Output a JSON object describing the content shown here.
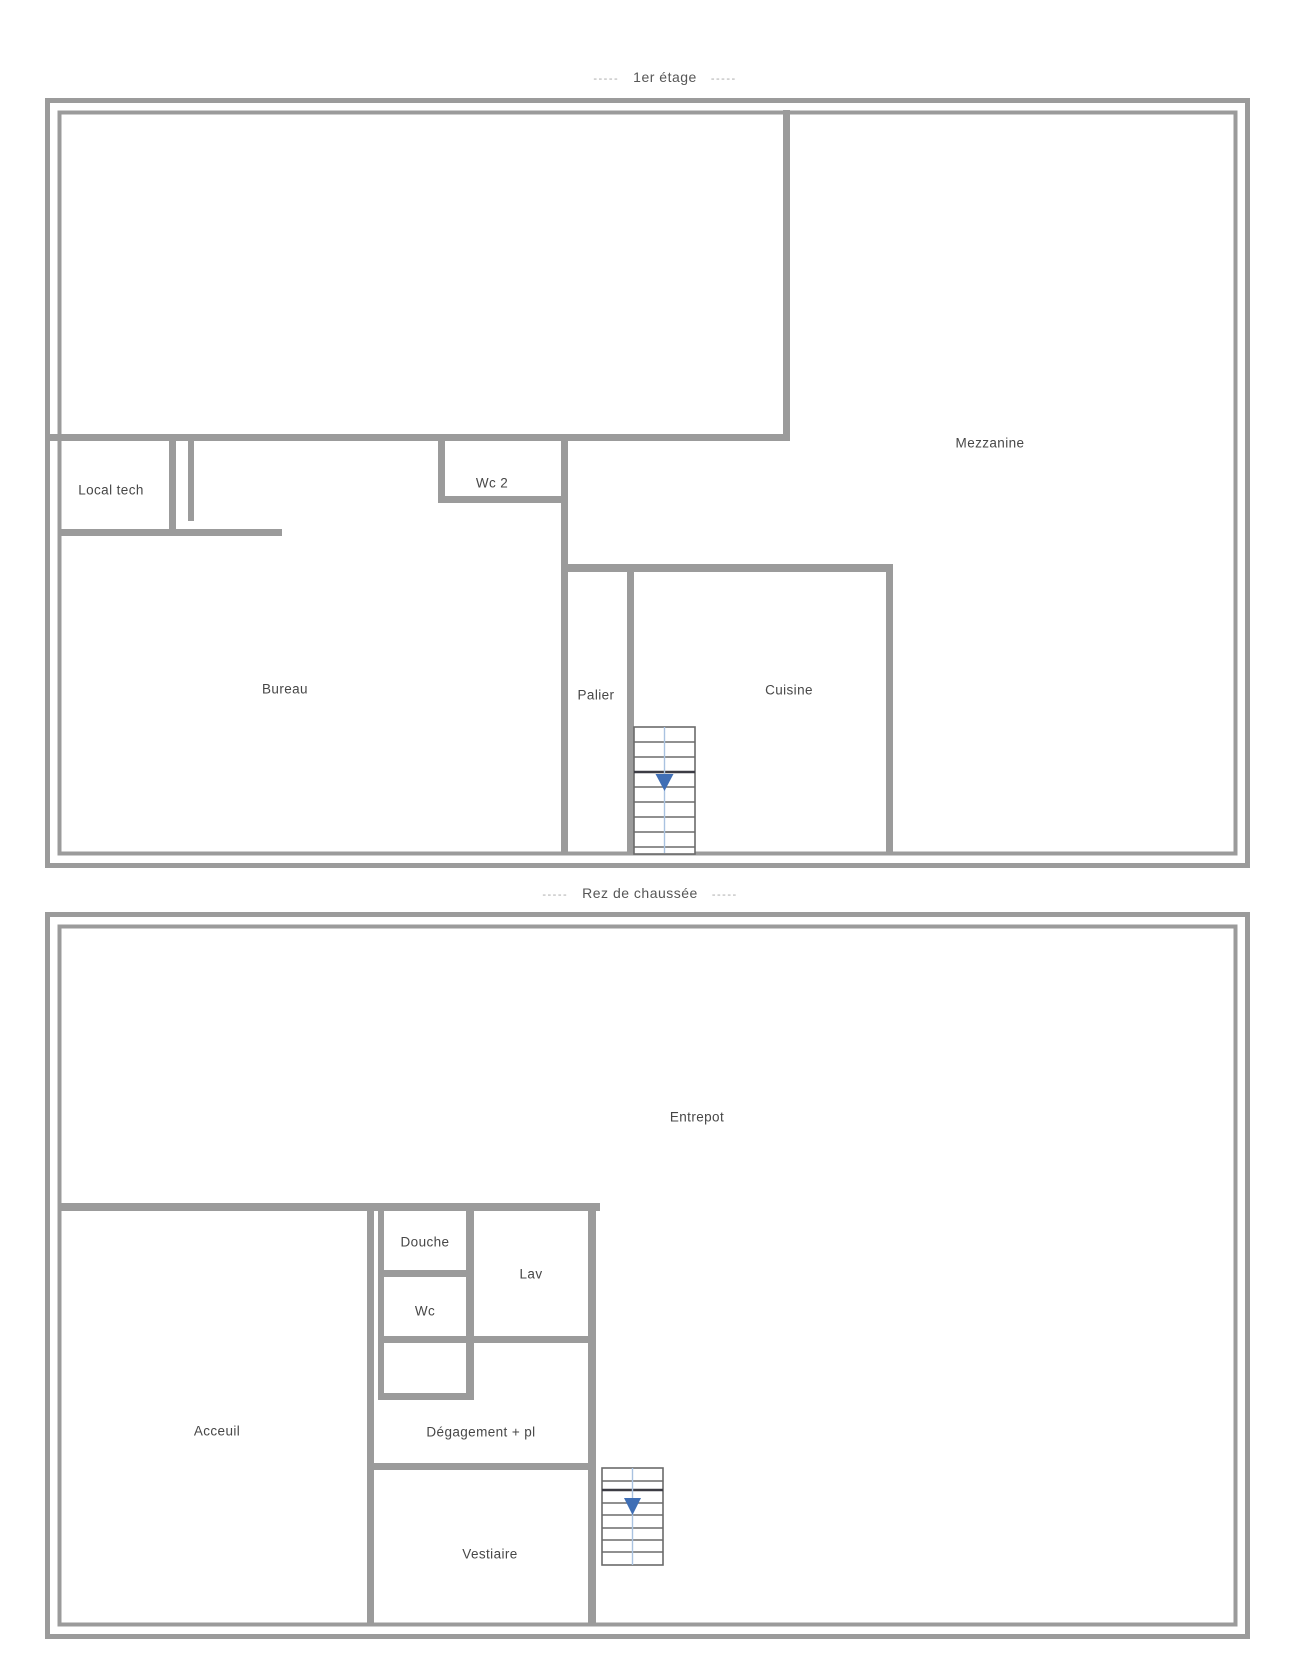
{
  "colors": {
    "background": "#ffffff",
    "wall": "#9b9b9b",
    "label_text": "#474747",
    "title_text": "#565656",
    "dash_text": "#a5a5a5",
    "stair_line": "#6b6b6b",
    "stair_dark_line": "#3c3c44",
    "stair_center_line": "#a9c2e0",
    "stair_arrow": "#3f6eb5"
  },
  "floors": [
    {
      "title": {
        "prefix_dashes": "-----",
        "label": "1er étage",
        "suffix_dashes": "-----"
      },
      "rooms": {
        "mezzanine": "Mezzanine",
        "local_tech": "Local tech",
        "wc_2": "Wc 2",
        "bureau": "Bureau",
        "palier": "Palier",
        "cuisine": "Cuisine"
      },
      "stair": {
        "direction": "down"
      }
    },
    {
      "title": {
        "prefix_dashes": "-----",
        "label": "Rez de chaussée",
        "suffix_dashes": "-----"
      },
      "rooms": {
        "entrepot": "Entrepot",
        "acceuil": "Acceuil",
        "douche": "Douche",
        "lav": "Lav",
        "wc": "Wc",
        "degagement_pl": "Dégagement + pl",
        "vestiaire": "Vestiaire"
      },
      "stair": {
        "direction": "down"
      }
    }
  ]
}
